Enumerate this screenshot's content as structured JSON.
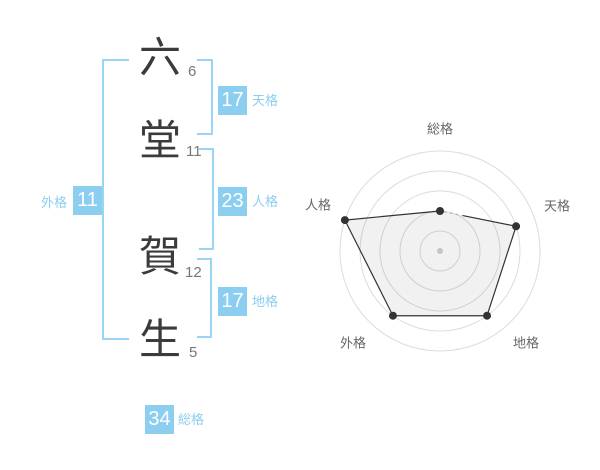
{
  "name_display": {
    "characters": [
      {
        "char": "六",
        "strokes": "6"
      },
      {
        "char": "堂",
        "strokes": "11"
      },
      {
        "char": "賀",
        "strokes": "12"
      },
      {
        "char": "生",
        "strokes": "5"
      }
    ]
  },
  "kaku": {
    "tenkaku": {
      "label": "天格",
      "value": "17"
    },
    "jinkaku": {
      "label": "人格",
      "value": "23"
    },
    "chikaku": {
      "label": "地格",
      "value": "17"
    },
    "gaikaku": {
      "label": "外格",
      "value": "11"
    },
    "soukaku": {
      "label": "総格",
      "value": "34"
    }
  },
  "colors": {
    "badge_blue": "#8BCEF0",
    "bracket_blue": "#9AD5F3",
    "label_blue": "#8BCEF0",
    "kanji_dark": "#3B3B3B",
    "stroke_gray": "#777777"
  },
  "chart_data": {
    "type": "radar",
    "axes": [
      "総格",
      "天格",
      "地格",
      "外格",
      "人格"
    ],
    "series": [
      {
        "name": "score",
        "values": [
          2,
          4,
          4,
          4,
          5
        ]
      }
    ],
    "value_max": 5,
    "rings": 5,
    "axis_stroke_values": {
      "総格": 34,
      "天格": 17,
      "地格": 17,
      "外格": 11,
      "人格": 23
    },
    "grid_on": true,
    "grid_color": "#DCDCDC",
    "line_color": "#333333",
    "fill_color": "rgba(0,0,0,0.055)",
    "point_color": "#333333",
    "center_dot_color": "#C4C4C4",
    "label_color": "#666666",
    "dashed_edge": {
      "from": "総格",
      "to": "天格",
      "color": "#B5B5B5"
    }
  }
}
